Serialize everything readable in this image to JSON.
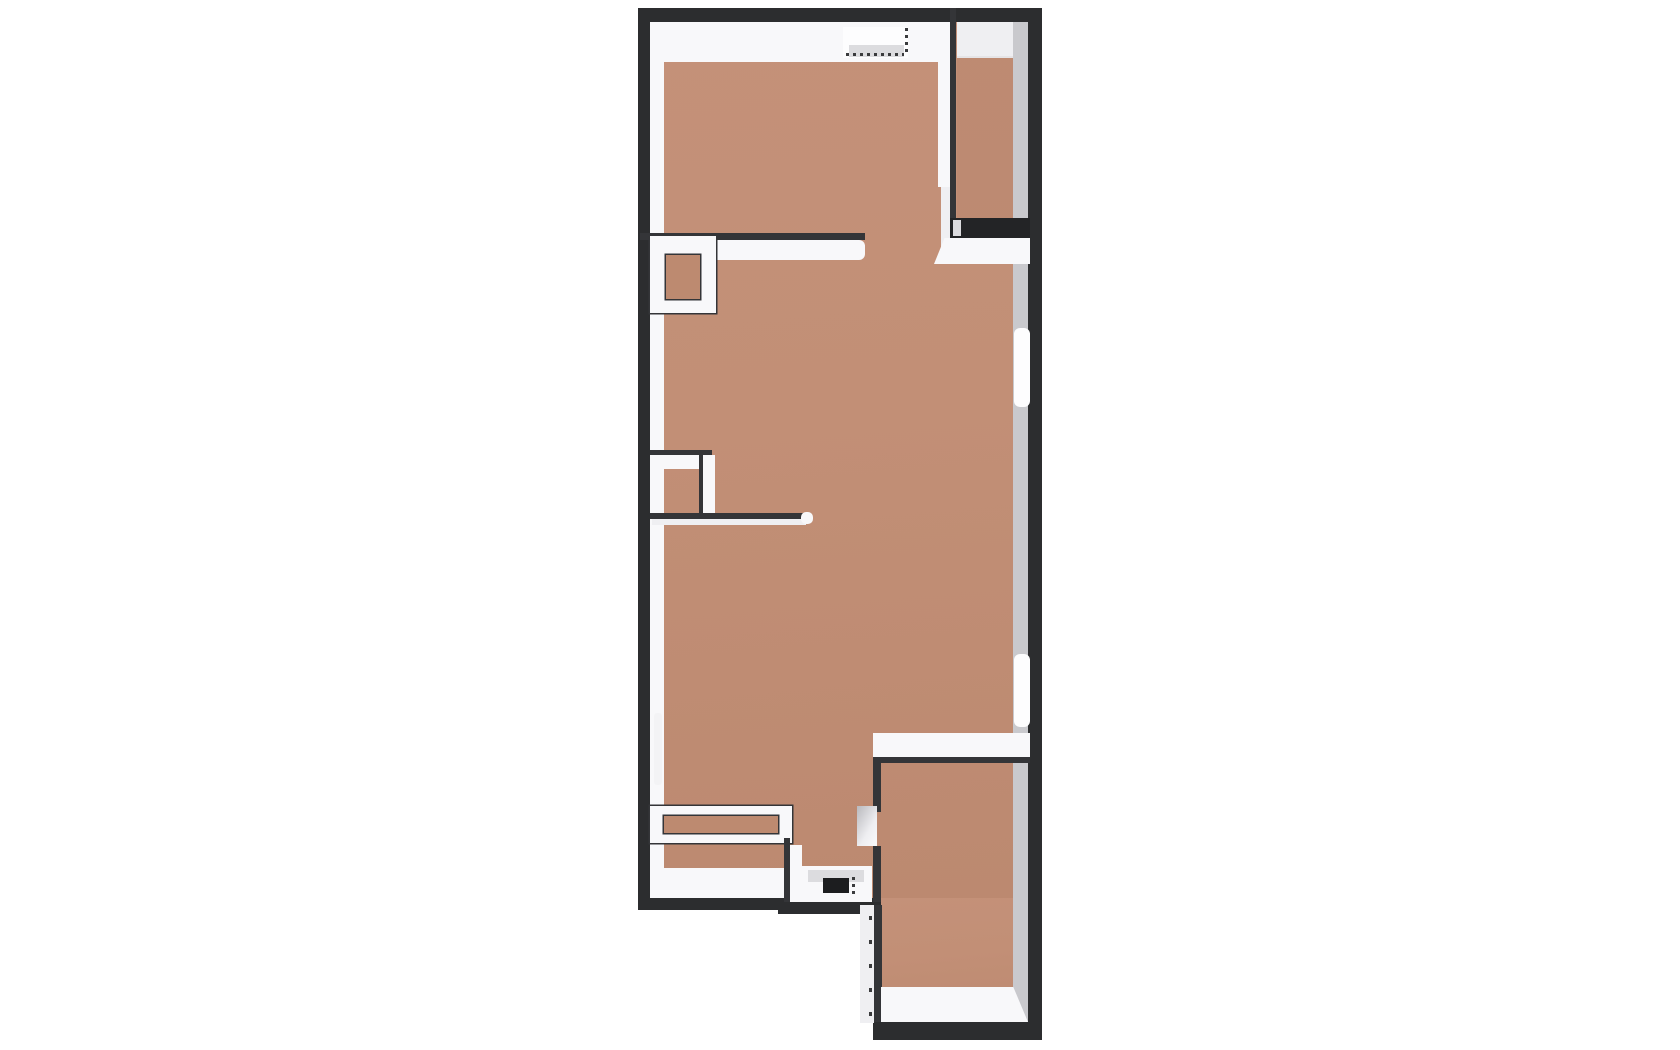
{
  "meta": {
    "description": "3D rendered top-down architectural floor plan of an apartment on a white background",
    "canvas": {
      "width": 1680,
      "height": 1050,
      "background": "#ffffff"
    }
  },
  "palette": {
    "outline": "#2c2d2f",
    "outline2": "#343538",
    "thresholdDark": "#232426",
    "doorLeaf": "#1c1d1f",
    "floor": "linear-gradient(175deg,#c49179 0%,#c28f76 45%,#bc8970 100%)",
    "floorDark": "#bd8a70",
    "floorShade": "rgba(70,40,25,0.05)",
    "white": "#f8f8fa",
    "whiteSoft": "#efeff2",
    "windowWhite": "#fdfdfe",
    "gray": "#c9c9cd",
    "grayLight": "#dcdcdf",
    "dash": "#3a3b3d"
  },
  "elements": [
    {
      "name": "outer-wall-body-main",
      "type": "rect",
      "x": 638,
      "y": 8,
      "w": 404,
      "h": 902,
      "fill": "outline"
    },
    {
      "name": "outer-wall-body-extension",
      "type": "rect",
      "x": 873,
      "y": 900,
      "w": 169,
      "h": 140,
      "fill": "outline"
    },
    {
      "name": "floor-main",
      "type": "rect",
      "x": 650,
      "y": 22,
      "w": 378,
      "h": 876,
      "fill": "floor"
    },
    {
      "name": "floor-extension",
      "type": "rect",
      "x": 874,
      "y": 898,
      "w": 154,
      "h": 124,
      "fill": "floor"
    },
    {
      "name": "wall-face-north",
      "type": "rect",
      "x": 650,
      "y": 22,
      "w": 300,
      "h": 40,
      "fill": "white",
      "clip": "polygon(0 0,100% 0,100% 100%,4.5% 100%,0 18%)"
    },
    {
      "name": "wall-face-north-balcony",
      "type": "rect",
      "x": 957,
      "y": 22,
      "w": 71,
      "h": 36,
      "fill": "whiteSoft",
      "clip": "polygon(0 0,100% 0,79% 100%,0 100%)"
    },
    {
      "name": "wall-face-west",
      "type": "rect",
      "x": 650,
      "y": 22,
      "w": 14,
      "h": 876,
      "fill": "white"
    },
    {
      "name": "wall-face-east",
      "type": "rect",
      "x": 1013,
      "y": 22,
      "w": 15,
      "h": 1000,
      "fill": "gray"
    },
    {
      "name": "wall-face-south-left",
      "type": "rect",
      "x": 650,
      "y": 868,
      "w": 140,
      "h": 30,
      "fill": "white",
      "clip": "polygon(10% 0,100% 0,100% 100%,0 100%)"
    },
    {
      "name": "balcony-partition-wall",
      "type": "rect",
      "x": 950,
      "y": 8,
      "w": 6,
      "h": 212,
      "fill": "outline2"
    },
    {
      "name": "balcony-partition-face",
      "type": "rect",
      "x": 938,
      "y": 22,
      "w": 12,
      "h": 165,
      "fill": "white"
    },
    {
      "name": "balcony-door-edge",
      "type": "rect",
      "x": 941,
      "y": 187,
      "w": 9,
      "h": 70,
      "fill": "whiteSoft"
    },
    {
      "name": "balcony-floor-shade",
      "type": "rect",
      "x": 957,
      "y": 56,
      "w": 56,
      "h": 162,
      "fill": "floorShade"
    },
    {
      "name": "balcony-sill-track",
      "type": "rect",
      "x": 950,
      "y": 218,
      "w": 80,
      "h": 20,
      "fill": "thresholdDark"
    },
    {
      "name": "balcony-sill-notch",
      "type": "rect",
      "x": 953,
      "y": 220,
      "w": 8,
      "h": 16,
      "fill": "grayLight"
    },
    {
      "name": "balcony-sill-face",
      "type": "rect",
      "x": 934,
      "y": 238,
      "w": 96,
      "h": 26,
      "fill": "white",
      "clip": "polygon(0 100%,11% 0,100% 0,100% 100%)"
    },
    {
      "name": "entry-door-top-opening",
      "type": "rect",
      "x": 843,
      "y": 27,
      "w": 65,
      "h": 31,
      "fill": "windowWhite"
    },
    {
      "name": "entry-door-top-threshold",
      "type": "rect",
      "x": 849,
      "y": 45,
      "w": 55,
      "h": 12,
      "fill": "grayLight"
    },
    {
      "name": "entry-door-top-swing-dash-v",
      "type": "dashes-v",
      "x": 905,
      "y": 28,
      "w": 3,
      "h": 28,
      "fill": "dash",
      "seg": 3,
      "gap": 4
    },
    {
      "name": "entry-door-top-swing-dash-h",
      "type": "dashes-h",
      "x": 846,
      "y": 53,
      "w": 58,
      "h": 3,
      "fill": "dash",
      "seg": 3,
      "gap": 4
    },
    {
      "name": "hall-wall-cap",
      "type": "rect",
      "x": 640,
      "y": 233,
      "w": 225,
      "h": 7,
      "fill": "outline2"
    },
    {
      "name": "hall-wall-face",
      "type": "rect",
      "x": 650,
      "y": 240,
      "w": 215,
      "h": 20,
      "fill": "white",
      "radius": "0 6px 6px 0"
    },
    {
      "name": "closet-frame",
      "type": "rect",
      "x": 650,
      "y": 236,
      "w": 66,
      "h": 77,
      "fill": "white",
      "stroke": "outline2"
    },
    {
      "name": "closet-inner",
      "type": "rect",
      "x": 666,
      "y": 255,
      "w": 34,
      "h": 44,
      "fill": "floorDark",
      "stroke": "outline2"
    },
    {
      "name": "mid-jamb-cap",
      "type": "rect",
      "x": 650,
      "y": 450,
      "w": 62,
      "h": 5,
      "fill": "outline2"
    },
    {
      "name": "mid-jamb-face",
      "type": "rect",
      "x": 652,
      "y": 455,
      "w": 60,
      "h": 14,
      "fill": "white"
    },
    {
      "name": "mid-jamb-vertical-cap",
      "type": "rect",
      "x": 699,
      "y": 455,
      "w": 4,
      "h": 65,
      "fill": "outline2"
    },
    {
      "name": "mid-jamb-vertical-face",
      "type": "rect",
      "x": 703,
      "y": 455,
      "w": 12,
      "h": 65,
      "fill": "white"
    },
    {
      "name": "partition-thin-wall-cap",
      "type": "rect",
      "x": 650,
      "y": 513,
      "w": 158,
      "h": 6,
      "fill": "outline2"
    },
    {
      "name": "partition-thin-wall-face",
      "type": "rect",
      "x": 652,
      "y": 519,
      "w": 154,
      "h": 6,
      "fill": "whiteSoft"
    },
    {
      "name": "partition-thin-wall-tip",
      "type": "rect",
      "x": 801,
      "y": 512,
      "w": 12,
      "h": 12,
      "fill": "white",
      "radius": "5px"
    },
    {
      "name": "window-left",
      "type": "rect",
      "x": 654,
      "y": 713,
      "w": 8,
      "h": 72,
      "fill": "#f3f3f5",
      "radius": "3px"
    },
    {
      "name": "window-right-upper",
      "type": "rect",
      "x": 1014,
      "y": 328,
      "w": 16,
      "h": 79,
      "fill": "windowWhite",
      "radius": "6px"
    },
    {
      "name": "window-right-lower",
      "type": "rect",
      "x": 1014,
      "y": 654,
      "w": 16,
      "h": 73,
      "fill": "windowWhite",
      "radius": "6px"
    },
    {
      "name": "bottomright-room-north-face",
      "type": "rect",
      "x": 873,
      "y": 733,
      "w": 157,
      "h": 24,
      "fill": "white"
    },
    {
      "name": "bottomright-room-north-cap",
      "type": "rect",
      "x": 876,
      "y": 757,
      "w": 154,
      "h": 6,
      "fill": "outline2"
    },
    {
      "name": "bottomright-room-west-wall-upper",
      "type": "rect",
      "x": 873,
      "y": 757,
      "w": 8,
      "h": 55,
      "fill": "outline2"
    },
    {
      "name": "bottomright-room-door-jamb",
      "type": "rect",
      "x": 857,
      "y": 806,
      "w": 20,
      "h": 40,
      "fill": "linear-gradient(120deg,#b9b9bd 0%,#eeeef1 60%,#fafafc 100%)"
    },
    {
      "name": "bottomright-room-west-wall-lower",
      "type": "rect",
      "x": 873,
      "y": 846,
      "w": 8,
      "h": 60,
      "fill": "outline2"
    },
    {
      "name": "low-wall-frame",
      "type": "rect",
      "x": 650,
      "y": 806,
      "w": 142,
      "h": 37,
      "fill": "white",
      "stroke": "outline2"
    },
    {
      "name": "low-wall-inner",
      "type": "rect",
      "x": 664,
      "y": 816,
      "w": 114,
      "h": 17,
      "fill": "floorDark",
      "stroke": "outline2"
    },
    {
      "name": "alcove-west-cap",
      "type": "rect",
      "x": 784,
      "y": 838,
      "w": 6,
      "h": 68,
      "fill": "outline2"
    },
    {
      "name": "alcove-west-face",
      "type": "rect",
      "x": 790,
      "y": 845,
      "w": 12,
      "h": 58,
      "fill": "white"
    },
    {
      "name": "entry-threshold",
      "type": "rect",
      "x": 798,
      "y": 866,
      "w": 74,
      "h": 40,
      "fill": "white"
    },
    {
      "name": "entry-threshold-shade",
      "type": "rect",
      "x": 808,
      "y": 870,
      "w": 56,
      "h": 12,
      "fill": "grayLight"
    },
    {
      "name": "entry-door-leaf",
      "type": "rect",
      "x": 823,
      "y": 878,
      "w": 26,
      "h": 15,
      "fill": "doorLeaf"
    },
    {
      "name": "entry-door-swing-dash-v",
      "type": "dashes-v",
      "x": 852,
      "y": 877,
      "w": 3,
      "h": 21,
      "fill": "dash",
      "seg": 3,
      "gap": 4
    },
    {
      "name": "alcove-bottom-cap",
      "type": "rect",
      "x": 778,
      "y": 902,
      "w": 103,
      "h": 12,
      "fill": "outline"
    },
    {
      "name": "extension-west-face",
      "type": "rect",
      "x": 860,
      "y": 905,
      "w": 14,
      "h": 118,
      "fill": "whiteSoft"
    },
    {
      "name": "extension-door-swing-dash-v",
      "type": "dashes-v",
      "x": 869,
      "y": 916,
      "w": 3,
      "h": 100,
      "fill": "dash",
      "seg": 4,
      "gap": 20
    },
    {
      "name": "extension-west-cap",
      "type": "rect",
      "x": 874,
      "y": 905,
      "w": 8,
      "h": 117,
      "fill": "outline2"
    },
    {
      "name": "bottomright-room-south-face",
      "type": "rect",
      "x": 881,
      "y": 987,
      "w": 147,
      "h": 35,
      "fill": "white",
      "clip": "polygon(0 0,90% 0,100% 100%,0 100%)"
    }
  ]
}
